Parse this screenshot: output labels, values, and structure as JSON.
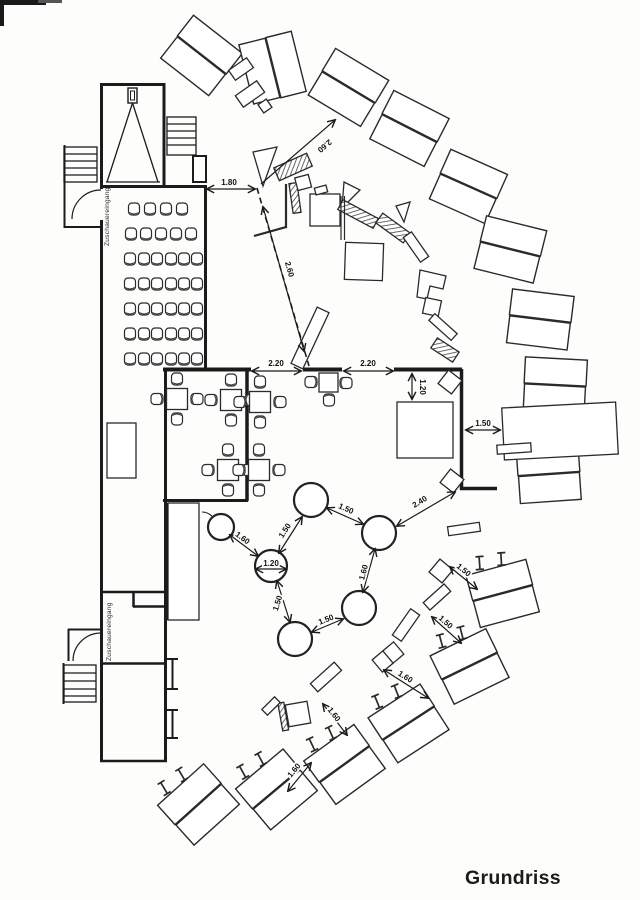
{
  "title": "Grundriss",
  "labels": {
    "entrance_top": "Zuschauereingang",
    "entrance_bottom": "Zuschauereingang"
  },
  "dimensions": {
    "entry_top": "1.80",
    "stage_diag": "2.60",
    "stage_dash": "2.60",
    "rest_left": "2.20",
    "rest_right": "2.20",
    "stage_gap": "1.20",
    "table_right": "1.50",
    "corner_to_circle": "2.40",
    "circle_left": "1.60",
    "circle_topleft": "1.50",
    "circle_top": "1.50",
    "circle_diameter": "1.20",
    "circle_right": "1.60",
    "circle_bottom": "1.50",
    "circle_bottomleft": "1.50",
    "arc_ne": "1.50",
    "arc_e": "1.50",
    "arc_se": "1.60",
    "arc_s": "1.60",
    "arc_sw": "1.60"
  }
}
